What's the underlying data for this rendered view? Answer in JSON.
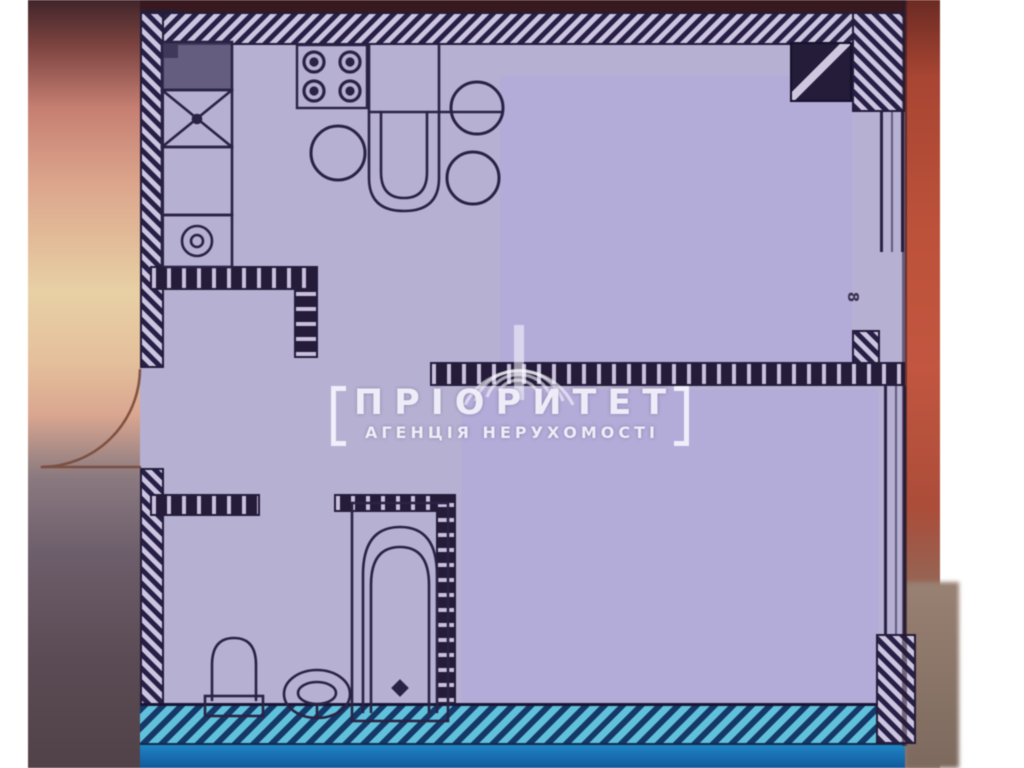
{
  "watermark": {
    "title": "ПРІОРИТЕТ",
    "subtitle": "АГЕНЦІЯ НЕРУХОМОСТІ"
  },
  "plan": {
    "dimension_label": "8",
    "type": "one-room apartment floor plan scan",
    "fixtures": [
      "kitchen-counter",
      "kitchen-sink",
      "washing-machine",
      "stove-4-burner",
      "dining-table",
      "stool",
      "stool",
      "stool",
      "entrance-door-swing",
      "toilet",
      "washbasin",
      "bathtub",
      "ventilation-shaft",
      "window-upper-right",
      "window-lower-right"
    ]
  },
  "colors": {
    "plan_background": "#b6b0d4",
    "redacted_patch": "#b3abd9",
    "wall_ink": "#241c3a",
    "wall_hatch_light": "#cdc4e0",
    "bottom_band_blue": "#1e86c9",
    "bottom_wall_teal": "#5fc2dc",
    "left_photo_cream": "#e9d0a4",
    "left_photo_pink": "#dda68b",
    "right_photo_orange": "#c05139",
    "door_arc_brown": "#7a4a38",
    "watermark_white": "#f8f7ff"
  }
}
